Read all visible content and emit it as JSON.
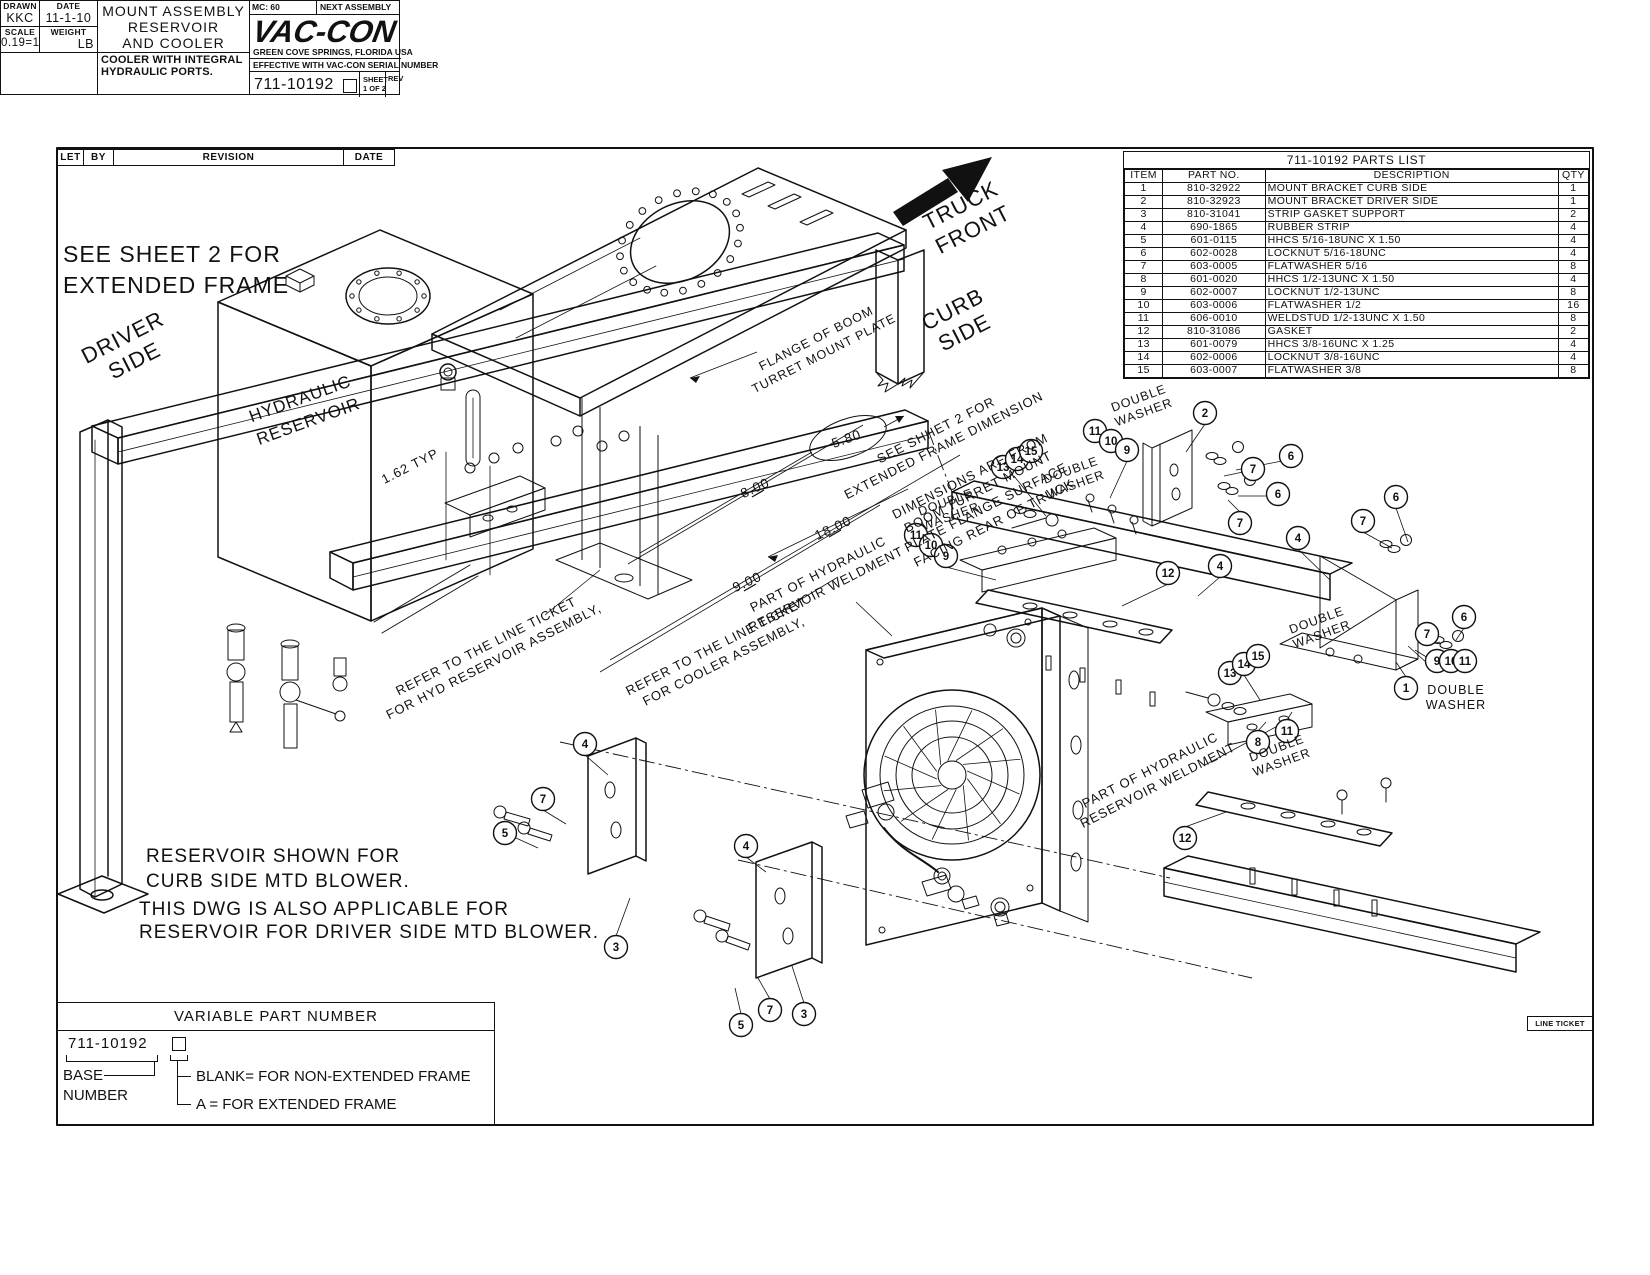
{
  "revision_table": {
    "headers": [
      "LET",
      "BY",
      "REVISION",
      "DATE"
    ]
  },
  "parts_list": {
    "title": "711-10192 PARTS LIST",
    "headers": [
      "ITEM",
      "PART NO.",
      "DESCRIPTION",
      "QTY"
    ],
    "rows": [
      [
        "1",
        "810-32922",
        "MOUNT BRACKET CURB SIDE",
        "1"
      ],
      [
        "2",
        "810-32923",
        "MOUNT BRACKET DRIVER SIDE",
        "1"
      ],
      [
        "3",
        "810-31041",
        "STRIP GASKET SUPPORT",
        "2"
      ],
      [
        "4",
        "690-1865",
        "RUBBER STRIP",
        "4"
      ],
      [
        "5",
        "601-0115",
        "HHCS 5/16-18UNC X 1.50",
        "4"
      ],
      [
        "6",
        "602-0028",
        "LOCKNUT 5/16-18UNC",
        "4"
      ],
      [
        "7",
        "603-0005",
        "FLATWASHER 5/16",
        "8"
      ],
      [
        "8",
        "601-0020",
        "HHCS 1/2-13UNC X 1.50",
        "4"
      ],
      [
        "9",
        "602-0007",
        "LOCKNUT 1/2-13UNC",
        "8"
      ],
      [
        "10",
        "603-0006",
        "FLATWASHER 1/2",
        "16"
      ],
      [
        "11",
        "606-0010",
        "WELDSTUD 1/2-13UNC X 1.50",
        "8"
      ],
      [
        "12",
        "810-31086",
        "GASKET",
        "2"
      ],
      [
        "13",
        "601-0079",
        "HHCS 3/8-16UNC X 1.25",
        "4"
      ],
      [
        "14",
        "602-0006",
        "LOCKNUT 3/8-16UNC",
        "4"
      ],
      [
        "15",
        "603-0007",
        "FLATWASHER 3/8",
        "8"
      ]
    ]
  },
  "variable_part_number": {
    "header": "VARIABLE PART NUMBER",
    "number": "711-10192",
    "base_line1": "BASE",
    "base_line2": "NUMBER",
    "option_blank": "BLANK= FOR NON-EXTENDED FRAME",
    "option_a": "A = FOR EXTENDED FRAME"
  },
  "title_block": {
    "drawn_label": "DRAWN",
    "drawn_value": "KKC",
    "date_label": "DATE",
    "date_value": "11-1-10",
    "scale_label": "SCALE",
    "scale_value": "0.19=1",
    "weight_label": "WEIGHT",
    "weight_value": "LB",
    "title_lines": [
      "MOUNT ASSEMBLY",
      "RESERVOIR",
      "AND COOLER"
    ],
    "note_lines": [
      "COOLER WITH INTEGRAL",
      "HYDRAULIC PORTS."
    ],
    "mc": "MC: 60",
    "line_ticket": "LINE TICKET",
    "next_assembly": "NEXT ASSEMBLY",
    "logo": "VAC-CON",
    "address": "GREEN COVE SPRINGS, FLORIDA USA",
    "effective": "EFFECTIVE WITH VAC-CON SERIAL NUMBER",
    "number": "711-10192",
    "sheet_label": "SHEET",
    "sheet_value": "1 OF 2",
    "rev_label": "REV"
  },
  "drawing": {
    "labels": [
      {
        "lines": [
          "SEE SHEET 2 FOR",
          "EXTENDED FRAME"
        ],
        "x": 63,
        "y": 262,
        "r": 0,
        "s": 23,
        "a": "s",
        "lh": 31
      },
      {
        "lines": [
          "RESERVOIR SHOWN FOR",
          "CURB SIDE MTD BLOWER."
        ],
        "x": 146,
        "y": 862,
        "r": 0,
        "s": 19,
        "a": "s",
        "lh": 25
      },
      {
        "lines": [
          "THIS DWG IS ALSO APPLICABLE FOR",
          "RESERVOIR FOR DRIVER SIDE MTD BLOWER."
        ],
        "x": 139,
        "y": 915,
        "r": 0,
        "s": 19,
        "a": "s",
        "lh": 23
      },
      {
        "lines": [
          "DRIVER",
          "SIDE"
        ],
        "x": 126,
        "y": 344,
        "r": -27,
        "s": 22,
        "lh": 26
      },
      {
        "lines": [
          "TRUCK",
          "FRONT"
        ],
        "x": 964,
        "y": 212,
        "r": -27,
        "s": 22,
        "lh": 27
      },
      {
        "lines": [
          "CURB",
          "SIDE"
        ],
        "x": 956,
        "y": 316,
        "r": -27,
        "s": 22,
        "lh": 26
      },
      {
        "lines": [
          "HYDRAULIC",
          "RESERVOIR"
        ],
        "x": 302,
        "y": 404,
        "r": -20,
        "s": 17,
        "lh": 24
      },
      {
        "lines": [
          "1.62 TYP"
        ],
        "x": 412,
        "y": 470,
        "r": -27,
        "s": 13
      },
      {
        "lines": [
          "FLANGE OF BOOM",
          "TURRET MOUNT PLATE"
        ],
        "x": 818,
        "y": 342,
        "r": -27,
        "s": 12.5,
        "lh": 17
      },
      {
        "lines": [
          "5.80"
        ],
        "x": 848,
        "y": 443,
        "r": -20,
        "s": 13.5
      },
      {
        "lines": [
          "8.00"
        ],
        "x": 757,
        "y": 492,
        "r": -25,
        "s": 13.5
      },
      {
        "lines": [
          "18.00"
        ],
        "x": 835,
        "y": 532,
        "r": -25,
        "s": 13.5
      },
      {
        "lines": [
          "9.00"
        ],
        "x": 749,
        "y": 586,
        "r": -25,
        "s": 13.5
      },
      {
        "lines": [
          "SEE SHHET 2 FOR",
          "EXTENDED FRAME DIMENSION"
        ],
        "x": 938,
        "y": 434,
        "r": -27,
        "s": 13,
        "lh": 17
      },
      {
        "lines": [
          "DIMENSIONS ARE FROM",
          "BOOM TURRET MOUNT",
          "PLATE FLANGE SURFACE",
          "FACING REAR OF TRUCK"
        ],
        "x": 972,
        "y": 480,
        "r": -27,
        "s": 13,
        "lh": 17.5
      },
      {
        "lines": [
          "DOUBLE",
          "WASHER"
        ],
        "x": 1140,
        "y": 402,
        "r": -20,
        "s": 12.5,
        "lh": 15
      },
      {
        "lines": [
          "DOUBLE",
          "WASHER"
        ],
        "x": 1072,
        "y": 474,
        "r": -20,
        "s": 12.5,
        "lh": 15
      },
      {
        "lines": [
          "DOUBLE",
          "WASHER"
        ],
        "x": 947,
        "y": 506,
        "r": -20,
        "s": 12.5,
        "lh": 15
      },
      {
        "lines": [
          "DOUBLE",
          "WASHER"
        ],
        "x": 1318,
        "y": 624,
        "r": -20,
        "s": 12.5,
        "lh": 15
      },
      {
        "lines": [
          "DOUBLE",
          "WASHER"
        ],
        "x": 1456,
        "y": 694,
        "r": 0,
        "s": 12.5,
        "lh": 15
      },
      {
        "lines": [
          "DOUBLE",
          "WASHER"
        ],
        "x": 1278,
        "y": 752,
        "r": -20,
        "s": 12.5,
        "lh": 15
      },
      {
        "lines": [
          "PART OF HYDRAULIC",
          "RESERVOIR WELDMENT"
        ],
        "x": 820,
        "y": 578,
        "r": -27,
        "s": 13,
        "lh": 17
      },
      {
        "lines": [
          "PART OF HYDRAULIC",
          "RESERVOIR WELDMENT"
        ],
        "x": 1152,
        "y": 774,
        "r": -27,
        "s": 13,
        "lh": 17
      },
      {
        "lines": [
          "REFER TO THE LINE TICKET",
          "FOR HYD RESERVOIR ASSEMBLY,"
        ],
        "x": 488,
        "y": 650,
        "r": -27,
        "s": 13,
        "lh": 17
      },
      {
        "lines": [
          "REFER TO THE LINE TICKET",
          "FOR COOLER ASSEMBLY,"
        ],
        "x": 718,
        "y": 650,
        "r": -27,
        "s": 13,
        "lh": 17
      }
    ],
    "balloons": [
      [
        "2",
        1205,
        413
      ],
      [
        "6",
        1291,
        456
      ],
      [
        "7",
        1253,
        469
      ],
      [
        "6",
        1278,
        494
      ],
      [
        "7",
        1240,
        523
      ],
      [
        "11",
        1095,
        431
      ],
      [
        "10",
        1111,
        441
      ],
      [
        "9",
        1127,
        450
      ],
      [
        "13",
        1003,
        467
      ],
      [
        "14",
        1017,
        459
      ],
      [
        "15",
        1031,
        451
      ],
      [
        "11",
        916,
        535
      ],
      [
        "10",
        931,
        545
      ],
      [
        "9",
        946,
        556
      ],
      [
        "12",
        1168,
        573
      ],
      [
        "4",
        1220,
        566
      ],
      [
        "4",
        1298,
        538
      ],
      [
        "7",
        1363,
        521
      ],
      [
        "6",
        1396,
        497
      ],
      [
        "7",
        1427,
        634
      ],
      [
        "6",
        1464,
        617
      ],
      [
        "9",
        1437,
        661
      ],
      [
        "10",
        1451,
        661
      ],
      [
        "11",
        1465,
        661
      ],
      [
        "1",
        1406,
        688
      ],
      [
        "13",
        1230,
        673
      ],
      [
        "14",
        1244,
        664
      ],
      [
        "15",
        1258,
        656
      ],
      [
        "8",
        1258,
        742
      ],
      [
        "11",
        1287,
        731
      ],
      [
        "12",
        1185,
        838
      ],
      [
        "4",
        585,
        744
      ],
      [
        "7",
        543,
        799
      ],
      [
        "5",
        505,
        833
      ],
      [
        "3",
        616,
        947
      ],
      [
        "4",
        746,
        846
      ],
      [
        "7",
        770,
        1010
      ],
      [
        "5",
        741,
        1025
      ],
      [
        "3",
        804,
        1014
      ]
    ]
  }
}
